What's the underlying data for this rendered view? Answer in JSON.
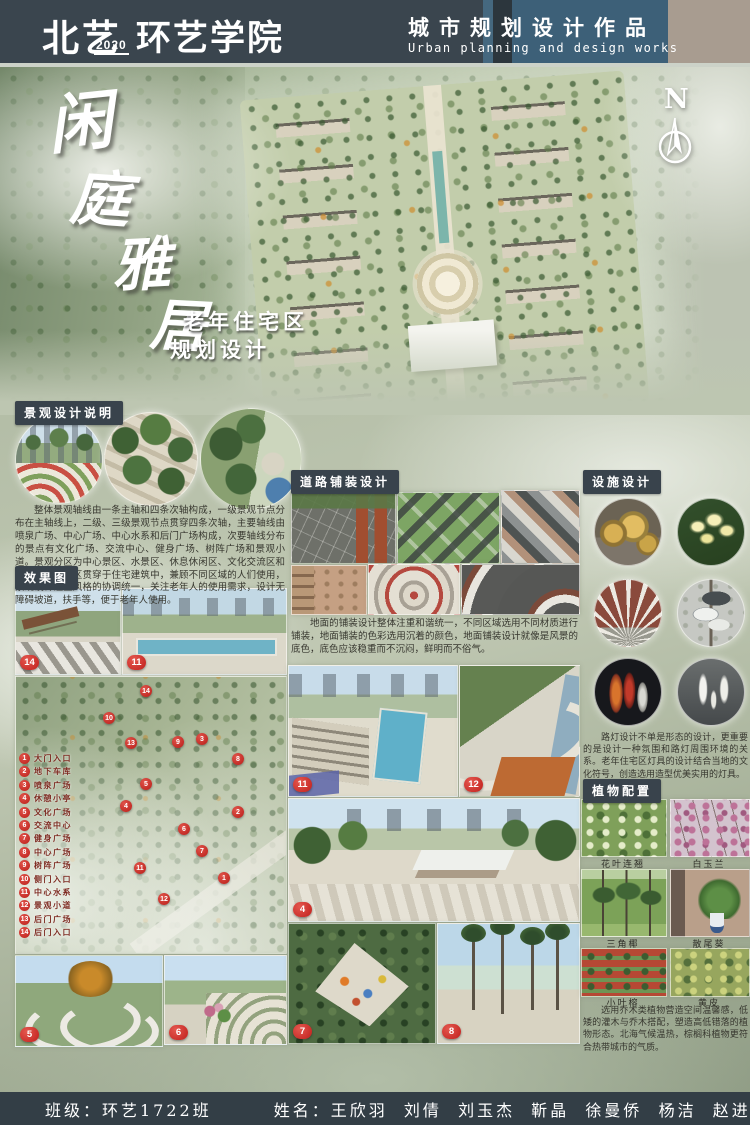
{
  "header": {
    "brand": "北艺",
    "year": "2020",
    "college": "环艺学院",
    "title_cn": "城市规划设计作品",
    "title_en": "Urban planning and design works"
  },
  "hero": {
    "t1": "闲",
    "t2": "庭",
    "t3": "雅",
    "t4": "居",
    "subtitle1": "老年住宅区",
    "subtitle2": "规划设计",
    "north": "N"
  },
  "landscape": {
    "title": "景观设计说明",
    "body": "整体景观轴线由一条主轴和四条次轴构成，一级景观节点分布在主轴线上，二级、三级景观节点贯穿四条次轴，主要轴线由喷泉广场、中心广场、中心水系和后门广场构成，次要轴线分布的景点有文化广场、交流中心、健身广场、树阵广场和景观小道。景观分区为中心景区、水景区、休息休闲区、文化交流区和健身区，景观区贯穿于住宅建筑中，兼顾不同区域的人们使用，景观设计注重风格的协调统一，关注老年人的使用需求，设计无障碍坡道，扶手等，便于老年人使用。"
  },
  "effects": {
    "title": "效果图"
  },
  "paving": {
    "title": "道路铺装设计",
    "body": "地面的铺装设计整体注重和谐统一，不同区域选用不同材质进行铺装，地面铺装的色彩选用沉着的颜色，地面铺装设计就像是风景的底色，底色应该稳重而不沉闷，鲜明而不俗气。"
  },
  "facility": {
    "title": "设施设计",
    "body": "路灯设计不单是形态的设计，更重要的是设计一种氛围和路灯周围环境的关系。老年住宅区灯具的设计结合当地的文化符号，创造选用造型优美实用的灯具。"
  },
  "plants": {
    "title": "植物配置",
    "body": "选用乔木类植物营造空间温馨感，低矮的灌木与乔木搭配，塑造高低错落的植物形态。北海气候温热，棕榈科植物更符合热带城市的气质。",
    "names": [
      "花叶连翘",
      "白玉兰",
      "三角椰",
      "散尾葵",
      "小叶榕",
      "黄皮"
    ]
  },
  "legend": {
    "items": [
      {
        "n": "1",
        "label": "大门入口"
      },
      {
        "n": "2",
        "label": "地下车库"
      },
      {
        "n": "3",
        "label": "喷泉广场"
      },
      {
        "n": "4",
        "label": "休憩小亭"
      },
      {
        "n": "5",
        "label": "文化广场"
      },
      {
        "n": "6",
        "label": "交流中心"
      },
      {
        "n": "7",
        "label": "健身广场"
      },
      {
        "n": "8",
        "label": "中心广场"
      },
      {
        "n": "9",
        "label": "树阵广场"
      },
      {
        "n": "10",
        "label": "侧门入口"
      },
      {
        "n": "11",
        "label": "中心水系"
      },
      {
        "n": "12",
        "label": "景观小道"
      },
      {
        "n": "13",
        "label": "后门广场"
      },
      {
        "n": "14",
        "label": "后门入口"
      }
    ]
  },
  "tags": {
    "e14": "14",
    "e11a": "11",
    "e11": "11",
    "e12": "12",
    "e4": "4",
    "e7": "7",
    "e8": "8",
    "e5": "5",
    "e6": "6"
  },
  "pins": [
    "1",
    "2",
    "3",
    "4",
    "5",
    "6",
    "7",
    "8",
    "9",
    "10",
    "11",
    "12",
    "13",
    "14"
  ],
  "footer": {
    "class": "班级：环艺1722班",
    "names": "姓名：王欣羽  刘倩  刘玉杰  靳晶  徐曼侨  杨洁  赵进歧"
  }
}
